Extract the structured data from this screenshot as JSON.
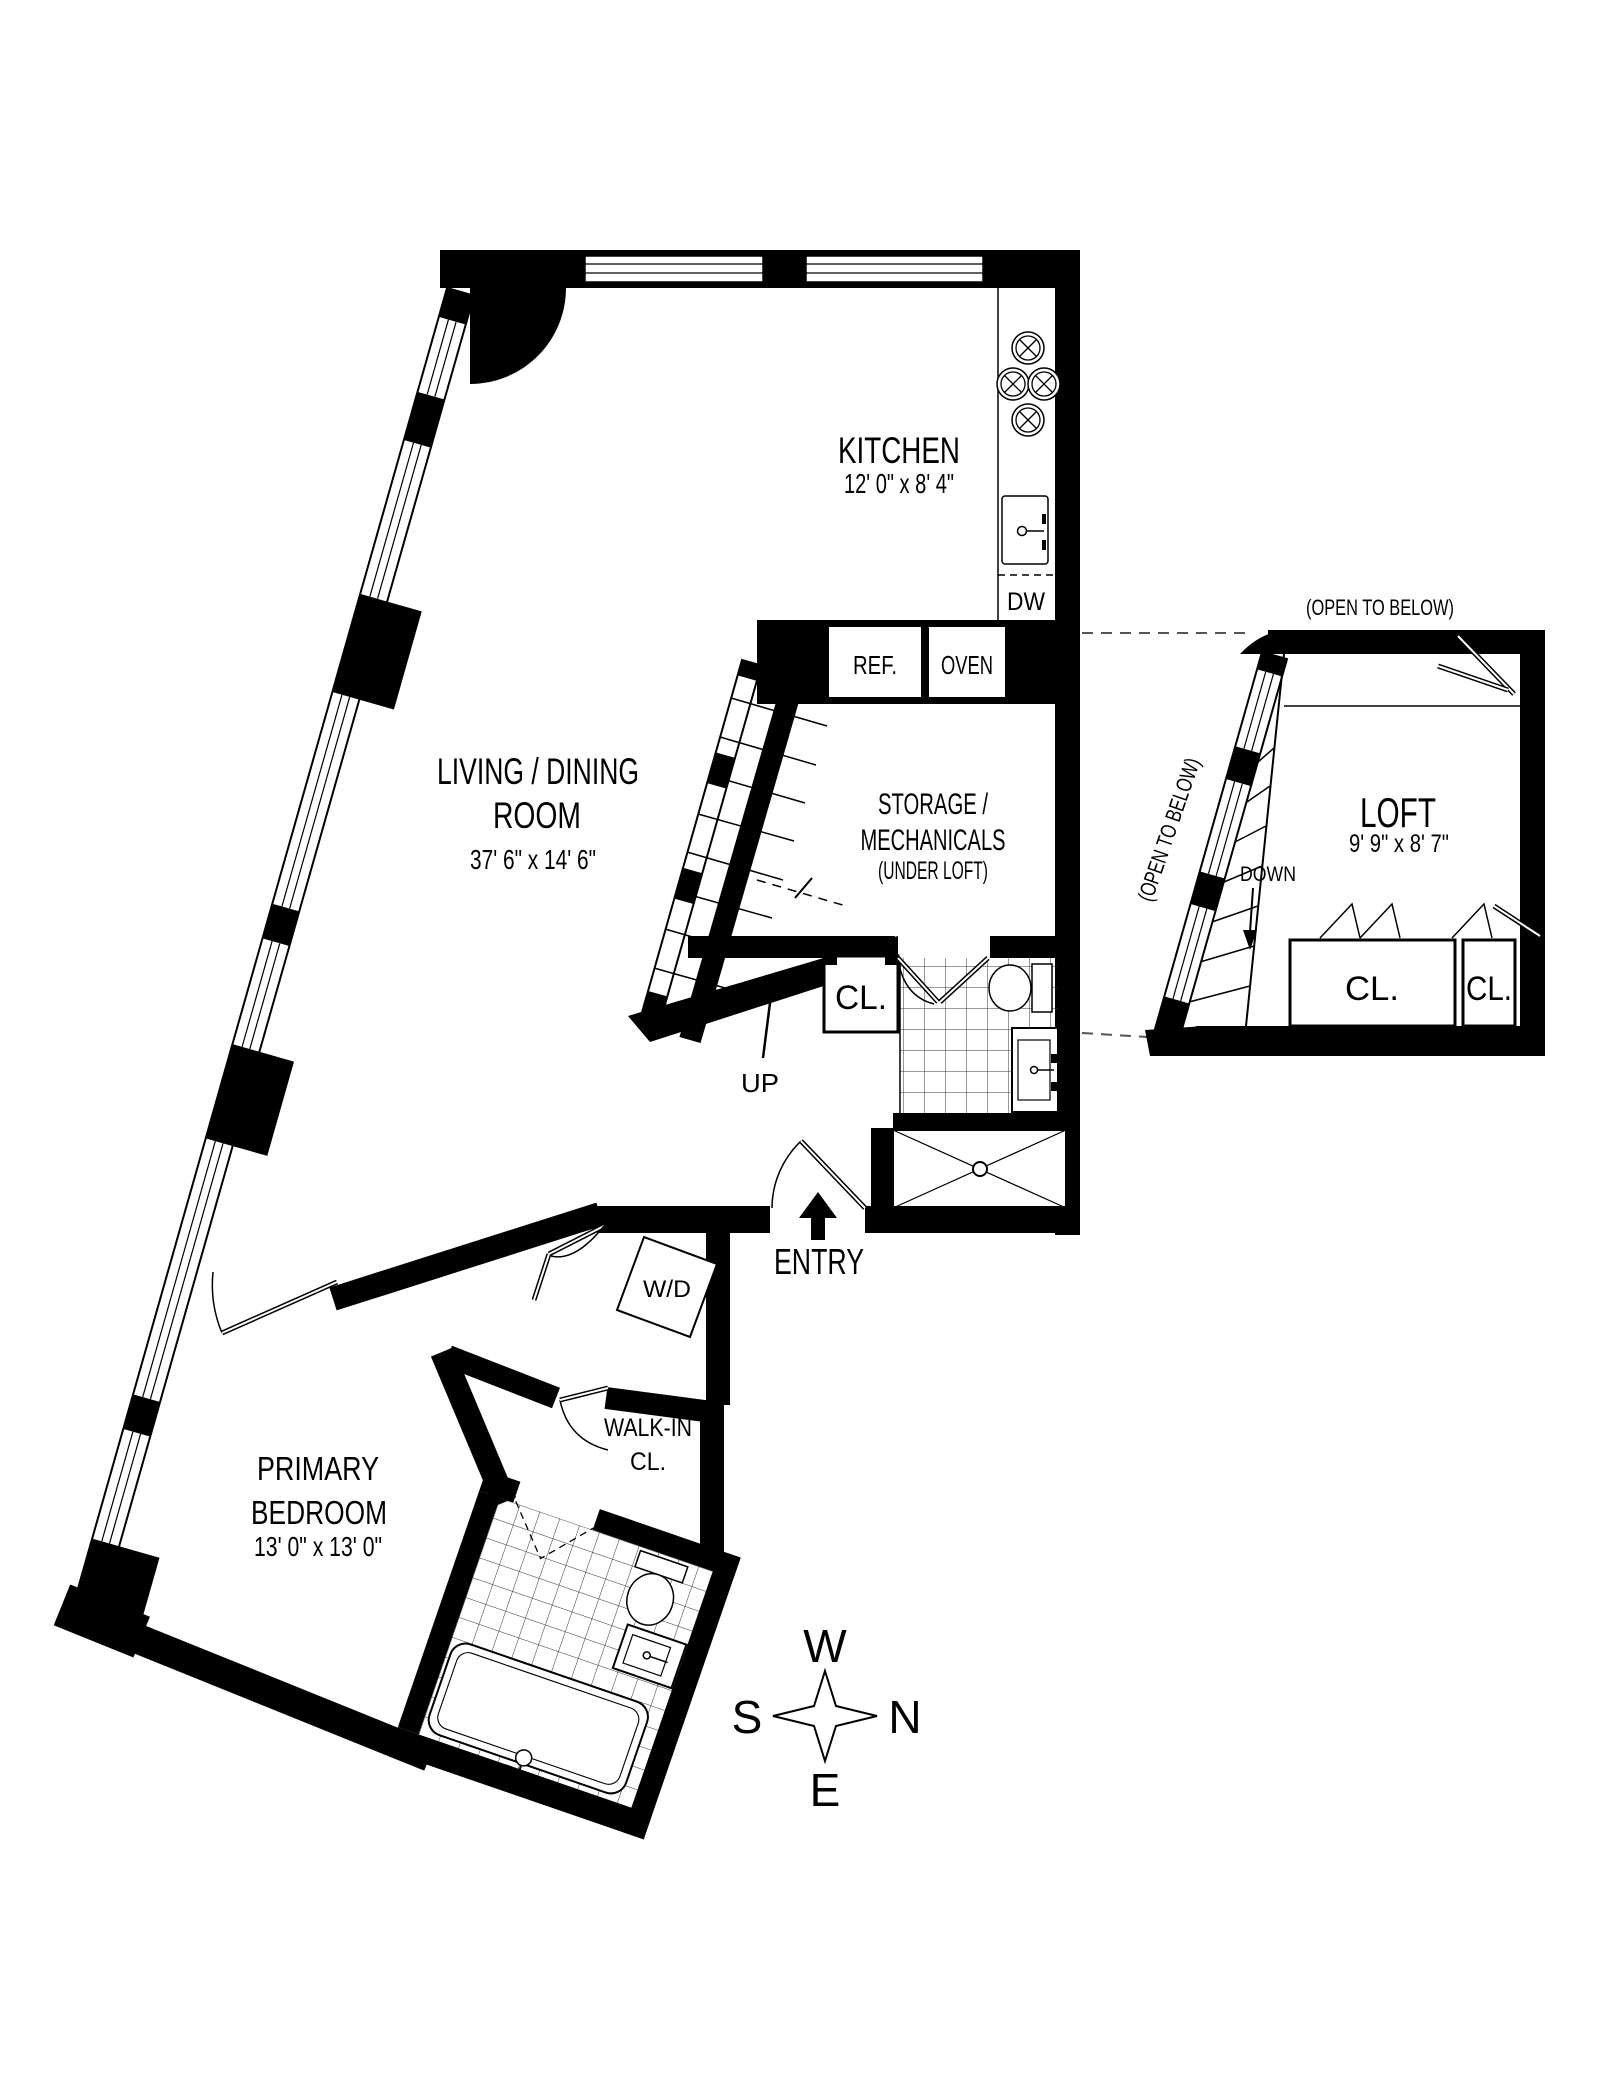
{
  "rooms": {
    "kitchen": {
      "name": "KITCHEN",
      "dims": "12' 0\" x 8' 4\""
    },
    "living": {
      "line1": "LIVING / DINING",
      "line2": "ROOM",
      "dims": "37' 6\" x 14' 6\""
    },
    "storage": {
      "line1": "STORAGE /",
      "line2": "MECHANICALS",
      "note": "(UNDER LOFT)"
    },
    "loft": {
      "name": "LOFT",
      "dims": "9' 9\" x 8' 7\"",
      "open_top": "(OPEN TO BELOW)",
      "open_side": "(OPEN TO BELOW)",
      "down": "DOWN"
    },
    "bedroom": {
      "line1": "PRIMARY",
      "line2": "BEDROOM",
      "dims": "13' 0\" x 13' 0\""
    },
    "walkin": {
      "line1": "WALK-IN",
      "line2": "CL."
    }
  },
  "labels": {
    "entry": "ENTRY",
    "up": "UP",
    "cl_bath": "CL.",
    "cl_loft_a": "CL.",
    "cl_loft_b": "CL.",
    "ref": "REF.",
    "oven": "OVEN",
    "dw": "DW",
    "wd": "W/D"
  },
  "compass": {
    "top": "W",
    "left": "S",
    "right": "N",
    "bottom": "E"
  },
  "colors": {
    "wall": "#000000",
    "background": "#ffffff",
    "tile_line": "#333333"
  }
}
